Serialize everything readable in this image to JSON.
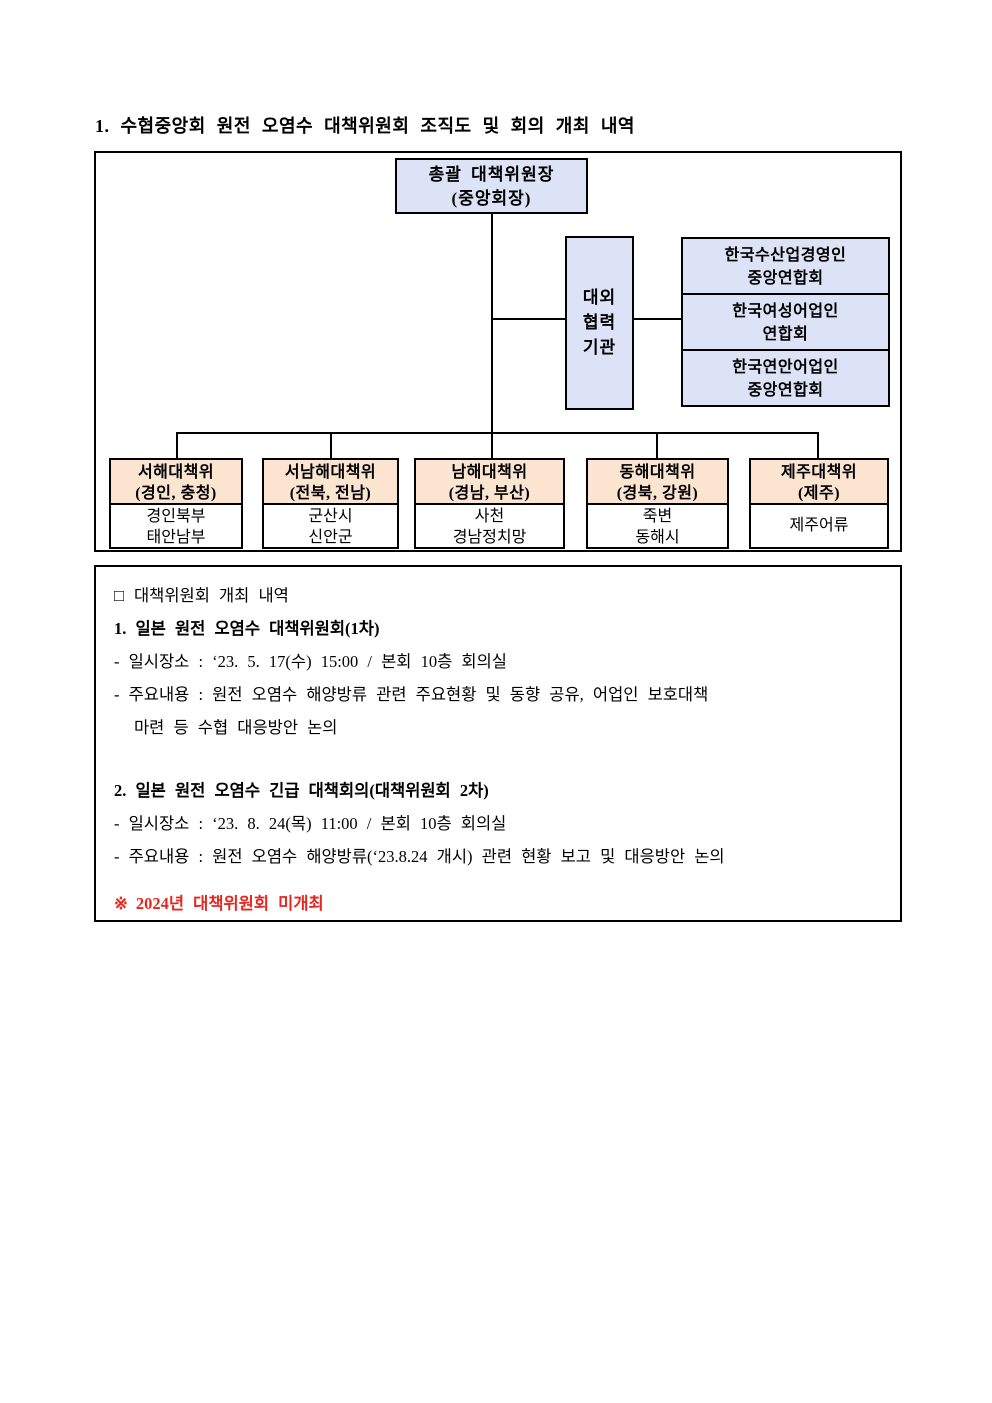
{
  "page": {
    "title": "1. 수협중앙회 원전 오염수 대책위원회 조직도 및 회의 개최 내역"
  },
  "colors": {
    "org_box_blue": "#dde3f6",
    "region_header_peach": "#fbe4d0",
    "note_red": "#e8251f"
  },
  "org_chart": {
    "chairman": {
      "line1": "총괄 대책위원장",
      "line2": "(중앙회장)"
    },
    "external": {
      "line1": "대외",
      "line2": "협력",
      "line3": "기관"
    },
    "external_orgs": [
      {
        "line1": "한국수산업경영인",
        "line2": "중앙연합회"
      },
      {
        "line1": "한국여성어업인",
        "line2": "연합회"
      },
      {
        "line1": "한국연안어업인",
        "line2": "중앙연합회"
      }
    ],
    "regional_committees": [
      {
        "name": "서해대책위",
        "region": "(경인, 충청)",
        "member1": "경인북부",
        "member2": "태안남부"
      },
      {
        "name": "서남해대책위",
        "region": "(전북, 전남)",
        "member1": "군산시",
        "member2": "신안군"
      },
      {
        "name": "남해대책위",
        "region": "(경남, 부산)",
        "member1": "사천",
        "member2": "경남정치망"
      },
      {
        "name": "동해대책위",
        "region": "(경북, 강원)",
        "member1": "죽변",
        "member2": "동해시"
      },
      {
        "name": "제주대책위",
        "region": "(제주)",
        "member1": "제주어류"
      }
    ]
  },
  "meetings": {
    "section": {
      "mark": "□",
      "title": "대책위원회 개최 내역"
    },
    "meeting1": {
      "heading": "1. 일본 원전 오염수 대책위원회(1차)",
      "when_where": "- 일시장소 : ‘23. 5. 17(수) 15:00 / 본회 10층 회의실",
      "content_line1": "- 주요내용 : 원전 오염수 해양방류 관련 주요현황 및 동향 공유, 어업인 보호대책",
      "content_line2": "마련 등 수협 대응방안 논의"
    },
    "meeting2": {
      "heading": "2. 일본 원전 오염수 긴급 대책회의(대책위원회 2차)",
      "when_where": "- 일시장소 : ‘23. 8. 24(목) 11:00 / 본회 10층 회의실",
      "content_line1": "- 주요내용 : 원전 오염수 해양방류(‘23.8.24 개시) 관련 현황 보고 및 대응방안 논의"
    },
    "note": {
      "mark": "※",
      "text": "2024년 대책위원회 미개최"
    }
  }
}
